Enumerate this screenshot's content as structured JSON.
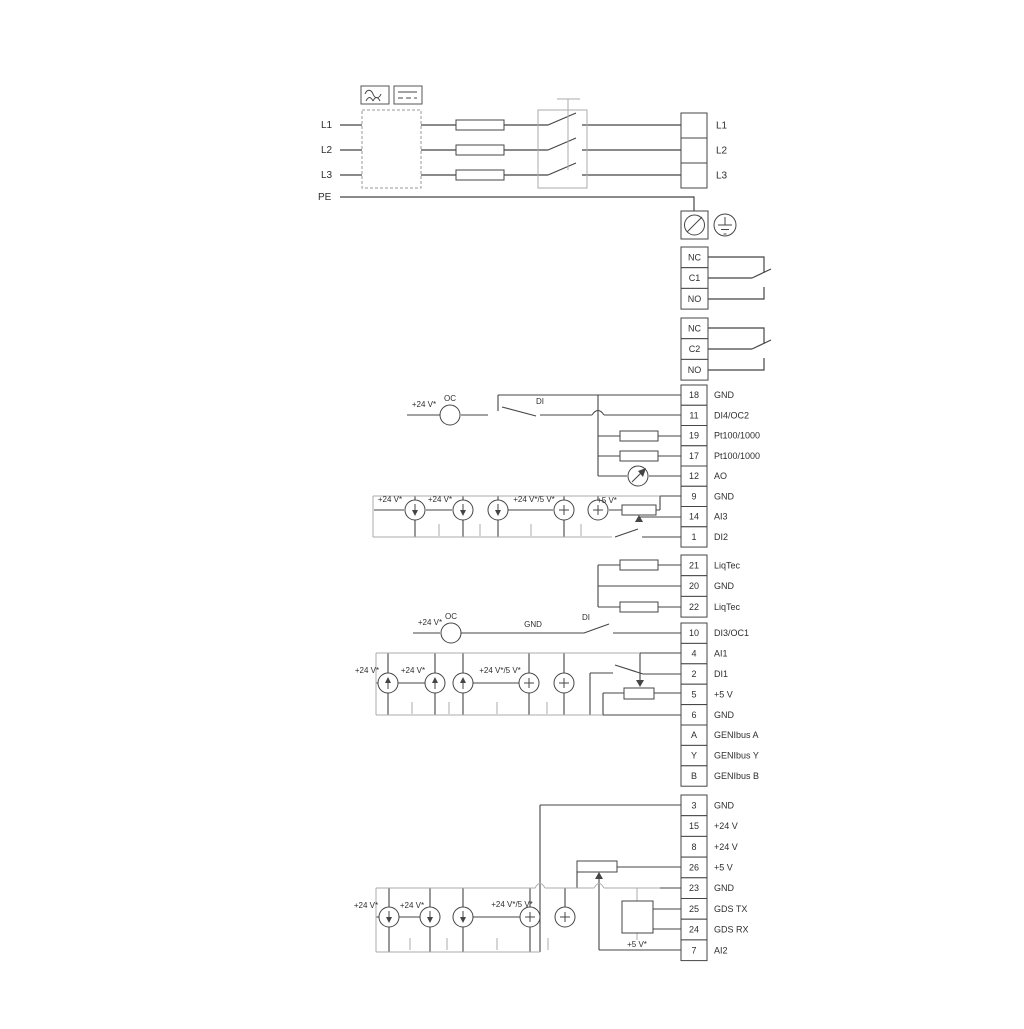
{
  "diagram_type": "electrical-wiring-diagram",
  "labels": {
    "l1": "L1",
    "l2": "L2",
    "l3": "L3",
    "pe": "PE",
    "v24": "+24 V*",
    "v24_5": "+24 V*/5 V*",
    "v5": "+5 V*",
    "oc": "OC",
    "di": "DI",
    "gnd": "GND"
  },
  "strips": {
    "output": {
      "cells": [
        {
          "n": "",
          "l": "L1"
        },
        {
          "n": "",
          "l": "L2"
        },
        {
          "n": "",
          "l": "L3"
        }
      ]
    },
    "relay1": {
      "cells": [
        {
          "n": "NC",
          "l": ""
        },
        {
          "n": "C1",
          "l": ""
        },
        {
          "n": "NO",
          "l": ""
        }
      ]
    },
    "relay2": {
      "cells": [
        {
          "n": "NC",
          "l": ""
        },
        {
          "n": "C2",
          "l": ""
        },
        {
          "n": "NO",
          "l": ""
        }
      ]
    },
    "io_top": {
      "cells": [
        {
          "n": "18",
          "l": "GND"
        },
        {
          "n": "11",
          "l": "DI4/OC2"
        },
        {
          "n": "19",
          "l": "Pt100/1000"
        },
        {
          "n": "17",
          "l": "Pt100/1000"
        },
        {
          "n": "12",
          "l": "AO"
        },
        {
          "n": "9",
          "l": "GND"
        },
        {
          "n": "14",
          "l": "AI3"
        },
        {
          "n": "1",
          "l": "DI2"
        }
      ]
    },
    "liqtec": {
      "cells": [
        {
          "n": "21",
          "l": "LiqTec"
        },
        {
          "n": "20",
          "l": "GND"
        },
        {
          "n": "22",
          "l": "LiqTec"
        }
      ]
    },
    "io_mid": {
      "cells": [
        {
          "n": "10",
          "l": "DI3/OC1"
        },
        {
          "n": "4",
          "l": "AI1"
        },
        {
          "n": "2",
          "l": "DI1"
        },
        {
          "n": "5",
          "l": "+5 V"
        },
        {
          "n": "6",
          "l": "GND"
        },
        {
          "n": "A",
          "l": "GENIbus A"
        },
        {
          "n": "Y",
          "l": "GENIbus Y"
        },
        {
          "n": "B",
          "l": "GENIbus B"
        }
      ]
    },
    "io_bottom": {
      "cells": [
        {
          "n": "3",
          "l": "GND"
        },
        {
          "n": "15",
          "l": "+24 V"
        },
        {
          "n": "8",
          "l": "+24 V"
        },
        {
          "n": "26",
          "l": "+5 V"
        },
        {
          "n": "23",
          "l": "GND"
        },
        {
          "n": "25",
          "l": "GDS TX"
        },
        {
          "n": "24",
          "l": "GDS RX"
        },
        {
          "n": "7",
          "l": "AI2"
        }
      ]
    }
  },
  "colors": {
    "wire_dark": "#454545",
    "wire_gray": "#ababab",
    "text": "#2e2e2e",
    "background": "#ffffff"
  }
}
